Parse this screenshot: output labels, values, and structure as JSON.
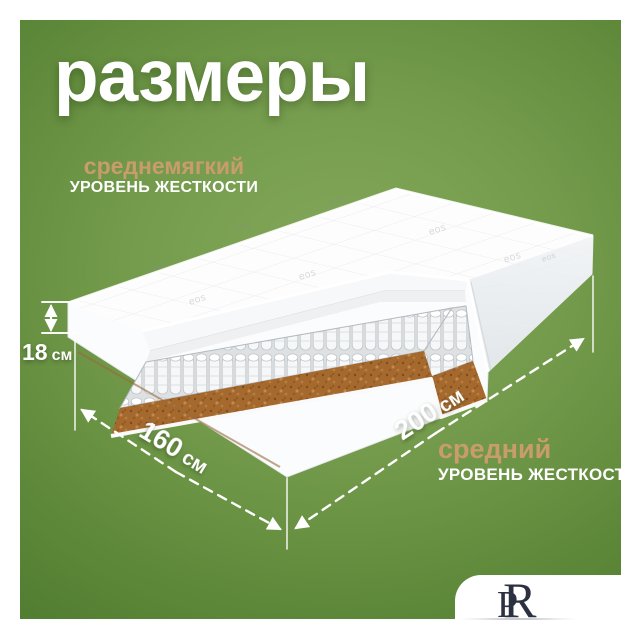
{
  "title": "размеры",
  "softness_top": {
    "value": "среднемягкий",
    "label": "УРОВЕНЬ ЖЕСТКОСТИ"
  },
  "softness_bottom": {
    "value": "средний",
    "label": "УРОВЕНЬ ЖЕСТКОСТИ"
  },
  "dimensions": {
    "height_value": "18",
    "height_unit": "см",
    "width_value": "160",
    "width_unit": "см",
    "length_value": "200",
    "length_unit": "см"
  },
  "fabric": {
    "logo_text": "eos"
  },
  "brand": {
    "monogram_left": "P",
    "monogram_right": "R"
  },
  "colors": {
    "background_green": "#5e8839",
    "accent_tan": "#c99c6b",
    "coir_brown": "#a5692e",
    "text_white": "#ffffff",
    "logo_navy": "#2b3140"
  }
}
